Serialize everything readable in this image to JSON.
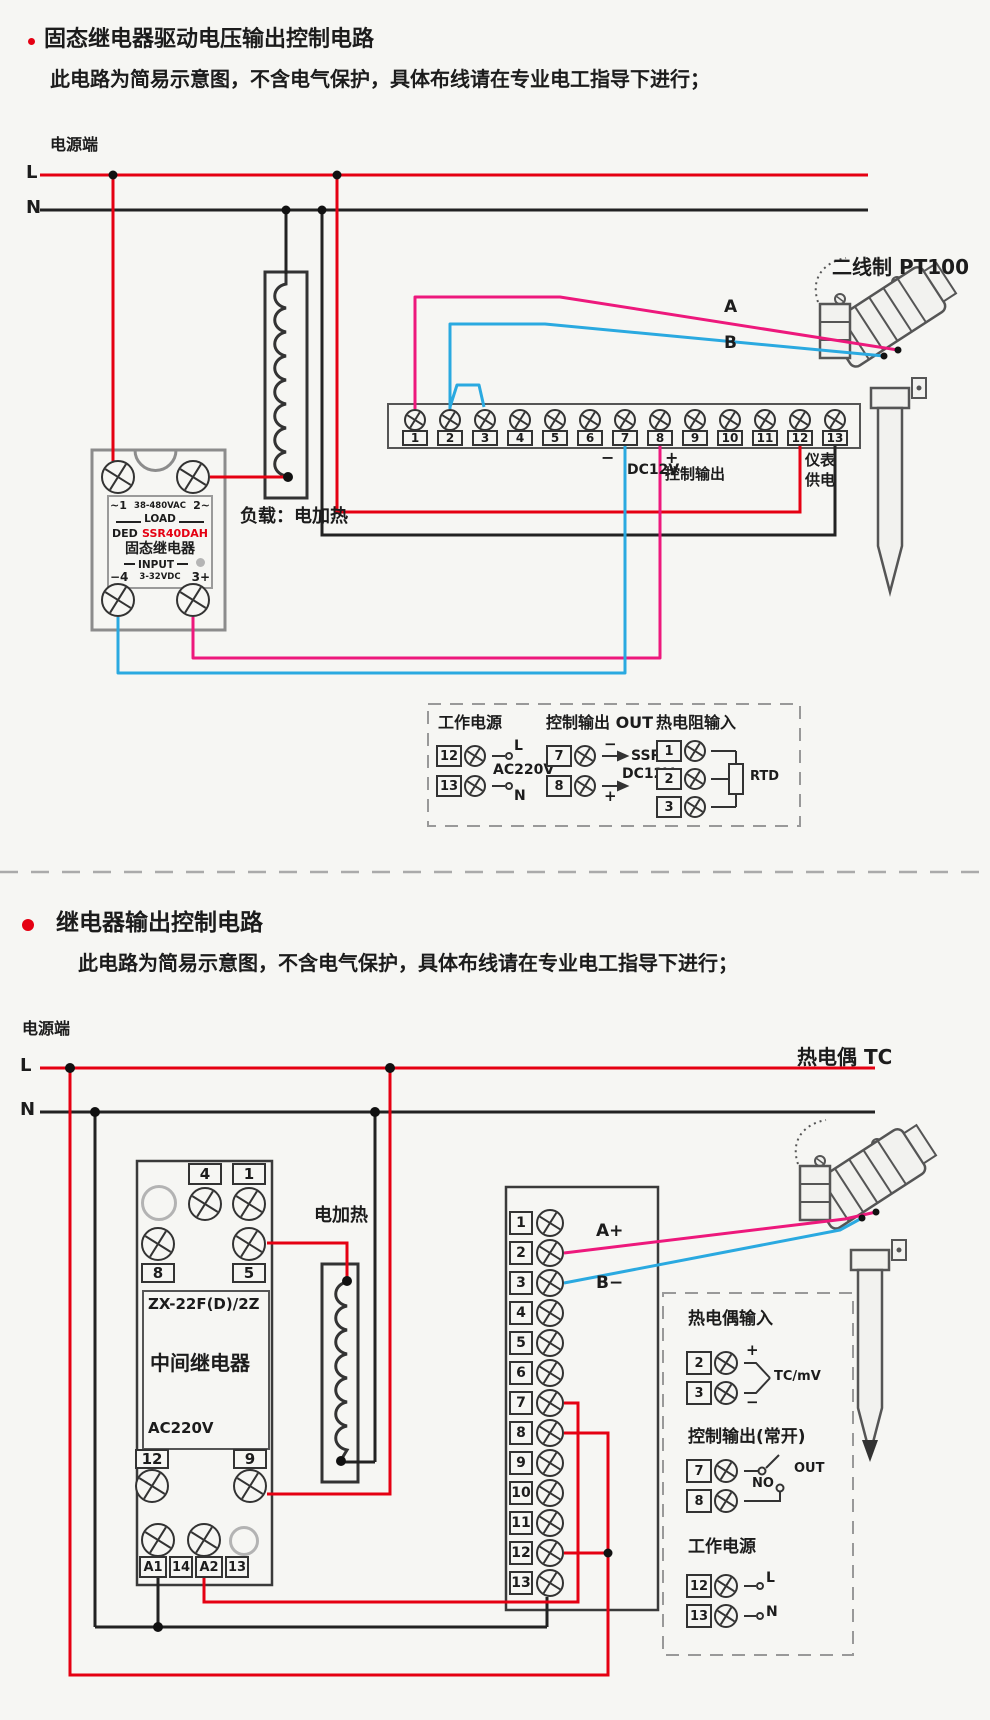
{
  "colors": {
    "red": "#e50012",
    "pink": "#ed187c",
    "blue": "#2aa9e0",
    "ink": "#222222"
  },
  "s1": {
    "title": "固态继电器驱动电压输出控制电路",
    "subtitle": "此电路为简易示意图，不含电气保护，具体布线请在专业电工指导下进行；",
    "power_label": "电源端",
    "l": "L",
    "n": "N",
    "ssr": {
      "t1a": "~1",
      "t1b": "38-480VAC",
      "t1c": "2~",
      "load": "LOAD",
      "brand": "DED",
      "model": "SSR40DAH",
      "name": "固态继电器",
      "input": "INPUT",
      "t6a": "−4",
      "t6b": "3-32VDC",
      "t6c": "3+"
    },
    "load_label": "负载：电加热",
    "terminals": [
      "1",
      "2",
      "3",
      "4",
      "5",
      "6",
      "7",
      "8",
      "9",
      "10",
      "11",
      "12",
      "13"
    ],
    "notes": {
      "minus": "−",
      "dc12v": "DC12V",
      "plus": "+",
      "ctrl": "控制输出",
      "meter1": "仪表",
      "meter2": "供电",
      "a": "A",
      "b": "B"
    },
    "sensor": "二线制 PT100",
    "legend": {
      "power": {
        "title": "工作电源",
        "t12": "12",
        "t13": "13",
        "l": "L",
        "n": "N",
        "mid": "AC220V"
      },
      "out": {
        "title": "控制输出 OUT",
        "t7": "7",
        "t8": "8",
        "minus": "−",
        "plus": "+",
        "ssr": "SSR",
        "dc12v": "DC12V"
      },
      "rtd": {
        "title": "热电阻输入",
        "t1": "1",
        "t2": "2",
        "t3": "3",
        "rtd": "RTD"
      }
    }
  },
  "s2": {
    "title": "继电器输出控制电路",
    "subtitle": "此电路为简易示意图，不含电气保护，具体布线请在专业电工指导下进行；",
    "power_label": "电源端",
    "l": "L",
    "n": "N",
    "relay": {
      "c4": "4",
      "c1": "1",
      "c8": "8",
      "c5": "5",
      "model": "ZX-22F(D)/2Z",
      "name": "中间继电器",
      "voltage": "AC220V",
      "c12": "12",
      "c9": "9",
      "a1": "A1",
      "c14": "14",
      "a2": "A2",
      "c13": "13"
    },
    "heater_label": "电加热",
    "terminals": [
      "1",
      "2",
      "3",
      "4",
      "5",
      "6",
      "7",
      "8",
      "9",
      "10",
      "11",
      "12",
      "13"
    ],
    "notes": {
      "a": "A+",
      "b": "B−"
    },
    "sensor": "热电偶 TC",
    "legend": {
      "tc": {
        "title": "热电偶输入",
        "t2": "2",
        "t3": "3",
        "plus": "+",
        "minus": "−",
        "mid": "TC/mV"
      },
      "out": {
        "title": "控制输出(常开)",
        "t7": "7",
        "t8": "8",
        "no": "NO",
        "out": "OUT"
      },
      "power": {
        "title": "工作电源",
        "t12": "12",
        "t13": "13",
        "l": "L",
        "n": "N"
      }
    }
  }
}
